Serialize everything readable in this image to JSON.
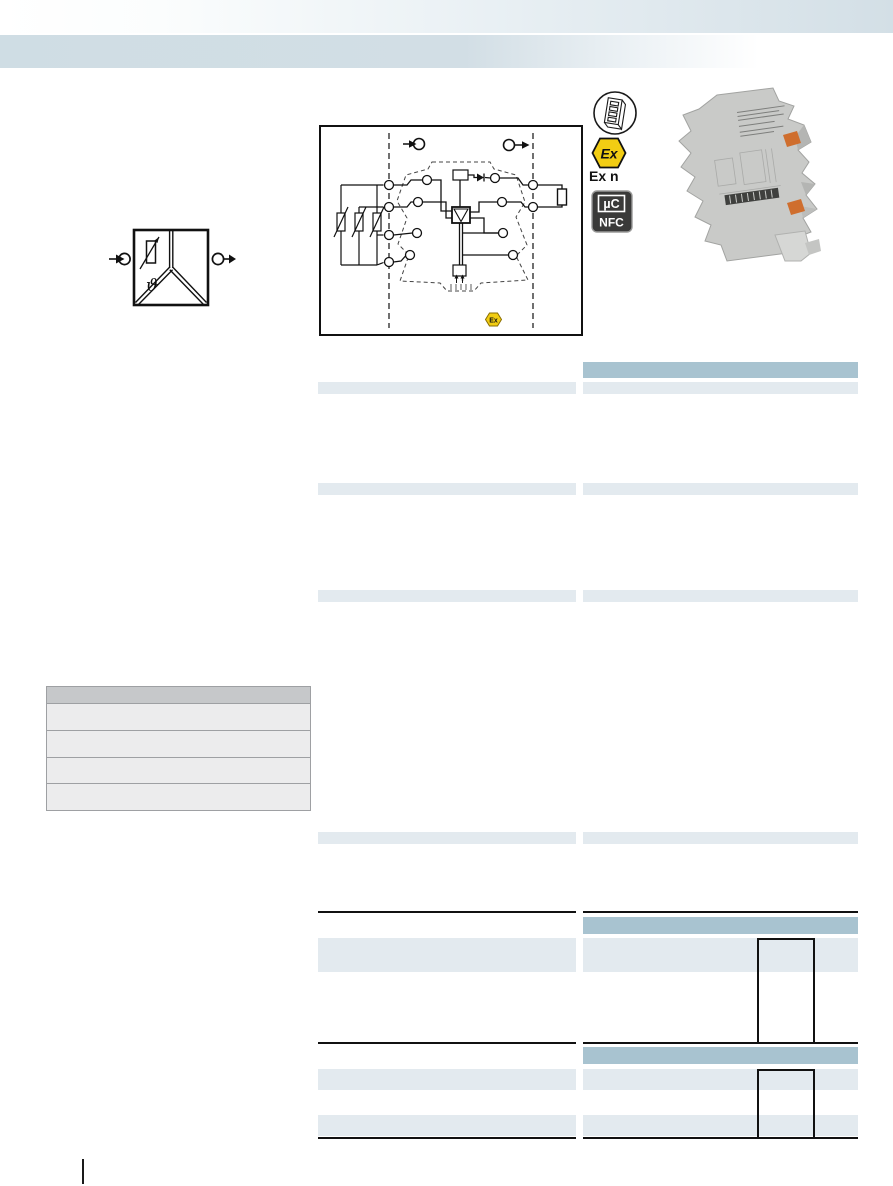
{
  "colors": {
    "header_blue": "#d3dfe6",
    "band_blue": "#cfdde4",
    "section_header_fill": "#a8c3d0",
    "row_band_fill": "#e3eaef",
    "order_table_header_fill": "#c6c8ca",
    "order_table_row_fill": "#ececed",
    "order_table_border": "#9ea0a3",
    "rule_black": "#111111",
    "ex_yellow": "#f2cd13",
    "module_gray": "#c9cac8",
    "connector_orange": "#cf6e2e"
  },
  "badges": {
    "dip_switch": {
      "name": "dip-switch-configuration"
    },
    "ex": {
      "hexagon_text": "Ex",
      "caption": "Ex n"
    },
    "nfc": {
      "line1": "µC",
      "line2": "NFC"
    }
  },
  "block_diagram": {
    "ex_hexagon_text": "Ex",
    "zones": 3,
    "input_terminal_count": 4,
    "output_terminal_count": 2
  },
  "symbol": {
    "theta_glyph": "ϑ"
  },
  "order_table": {
    "row_count": 4,
    "header_rows": 1
  },
  "spec_columns": {
    "left_row_bands": 7,
    "right_row_bands": 7,
    "right_section_headers": 3,
    "waveform_boxes": 2,
    "thick_rules_per_column": 3
  },
  "footer": {
    "page_marker_divider": true
  }
}
